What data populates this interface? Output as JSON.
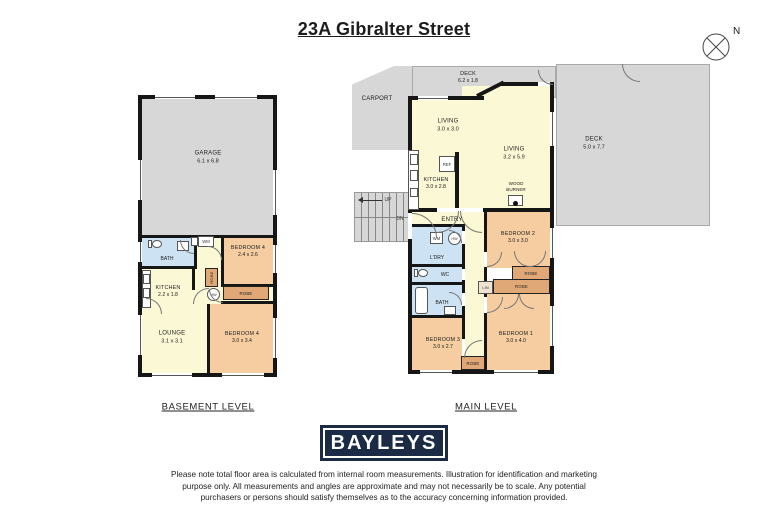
{
  "title": "23A Gibralter Street",
  "compass": {
    "n": "N"
  },
  "basement": {
    "level_label": "BASEMENT LEVEL",
    "garage": {
      "name": "GARAGE",
      "dims": "6.1 x 6.8"
    },
    "bath": {
      "name": "BATH"
    },
    "wm": {
      "name": "WM"
    },
    "bedroom4a": {
      "name": "BEDROOM 4",
      "dims": "2.4 x 2.6"
    },
    "kitchen": {
      "name": "KITCHEN",
      "dims": "2.2 x 1.8"
    },
    "robe_v": {
      "name": "ROBE"
    },
    "hw": {
      "name": "HW"
    },
    "robe_h": {
      "name": "ROBE"
    },
    "lounge": {
      "name": "LOUNGE",
      "dims": "3.1 x 3.1"
    },
    "bedroom4b": {
      "name": "BEDROOM 4",
      "dims": "3.0 x 3.4"
    }
  },
  "main": {
    "level_label": "MAIN LEVEL",
    "carport": {
      "name": "CARPORT"
    },
    "deck_top": {
      "name": "DECK",
      "dims": "6.2 x 1.8"
    },
    "deck_right": {
      "name": "DECK",
      "dims": "5.0 x 7.7"
    },
    "living_a": {
      "name": "LIVING",
      "dims": "3.0 x 3.0"
    },
    "living_b": {
      "name": "LIVING",
      "dims": "3.2 x 5.9"
    },
    "kitchen": {
      "name": "KITCHEN",
      "dims": "3.0 x 2.8"
    },
    "ref": {
      "name": "REF"
    },
    "wood_burner": {
      "line1": "WOOD",
      "line2": "BURNER"
    },
    "entry": {
      "name": "ENTRY"
    },
    "stairs": {
      "up": "UP",
      "dn": "DN"
    },
    "bedroom2": {
      "name": "BEDROOM 2",
      "dims": "3.0 x 3.0"
    },
    "ldry": {
      "name": "L'DRY"
    },
    "wm": {
      "name": "WM"
    },
    "hw": {
      "name": "HW"
    },
    "wc": {
      "name": "WC"
    },
    "bath": {
      "name": "BATH"
    },
    "lin": {
      "name": "LIN"
    },
    "robe_bed2": {
      "name": "ROBE"
    },
    "robe_bed1": {
      "name": "ROBE"
    },
    "robe_bed3": {
      "name": "ROBE"
    },
    "bedroom1": {
      "name": "BEDROOM 1",
      "dims": "3.0 x 4.0"
    },
    "bedroom3": {
      "name": "BEDROOM 3",
      "dims": "3.0 x 2.7"
    }
  },
  "logo": {
    "text": "BAYLEYS"
  },
  "disclaimer": "Please note total floor area is calculated from internal room measurements. Illustration for identification and marketing purpose only. All measurements and angles are approximate and may not necessarily be to scale. Any potential purchasers or persons should satisfy themselves as to the accuracy concerning information provided.",
  "colors": {
    "wall": "#161616",
    "gray": "#d7d7d7",
    "yellow": "#fbf8d6",
    "orange": "#f5cda1",
    "blue": "#cde2f2",
    "tan": "#e0a877",
    "navy": "#1b2a45"
  }
}
